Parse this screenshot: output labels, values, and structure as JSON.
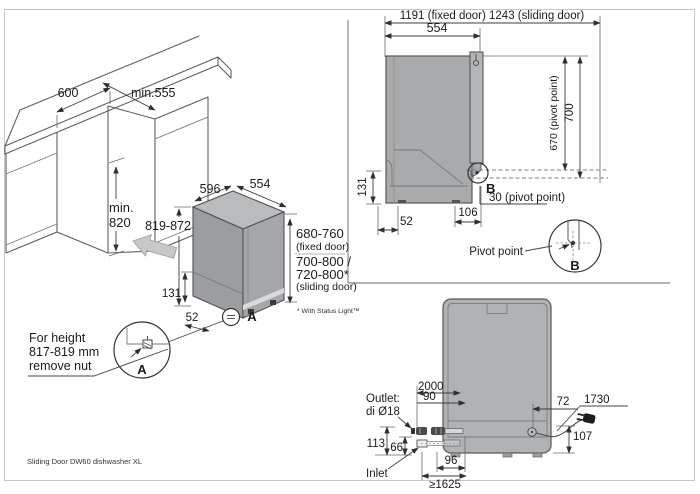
{
  "page": {
    "footer": "Sliding Door DW60 dishwasher XL"
  },
  "niche": {
    "width": "600",
    "depth": "min.555",
    "height_line1": "min.",
    "height_line2": "820"
  },
  "unit": {
    "depth": "596",
    "width": "554",
    "height": "819-872",
    "base": "131",
    "foot": "52",
    "ref": "A",
    "fixed_range": "680-760",
    "fixed_caption": "(fixed door)",
    "sliding_range1": "700-800 /",
    "sliding_range2": "720-800*",
    "sliding_caption": "(sliding door)",
    "footnote": "* With Status Light™"
  },
  "detail_a": {
    "ref": "A",
    "line1": "For height",
    "line2": "817-819 mm",
    "line3": "remove nut"
  },
  "side": {
    "overall": "1191 (fixed door) 1243 (sliding door)",
    "depth": "554",
    "pivot_height": "670 (pivot point)",
    "height": "700",
    "base": "131",
    "back": "52",
    "pivot_x": "106",
    "pivot_inset": "30 (pivot point)",
    "ref": "B"
  },
  "pivot": {
    "label": "Pivot point",
    "ref": "B"
  },
  "rear": {
    "drain": "2000",
    "outlet_x": "90",
    "cord_x": "72",
    "cord": "1730",
    "outlet1": "Outlet:",
    "outlet2": "di Ø18",
    "outlet_h": "113",
    "inlet_h": "66",
    "inlet": "Inlet",
    "spacing": "96",
    "reach": "≥1625",
    "cord_h": "107"
  },
  "colors": {
    "body_gray": "#a8aaac",
    "top_gray": "#b9bbbd",
    "dark_gray": "#9b9da0",
    "line": "#5a5a5a"
  }
}
